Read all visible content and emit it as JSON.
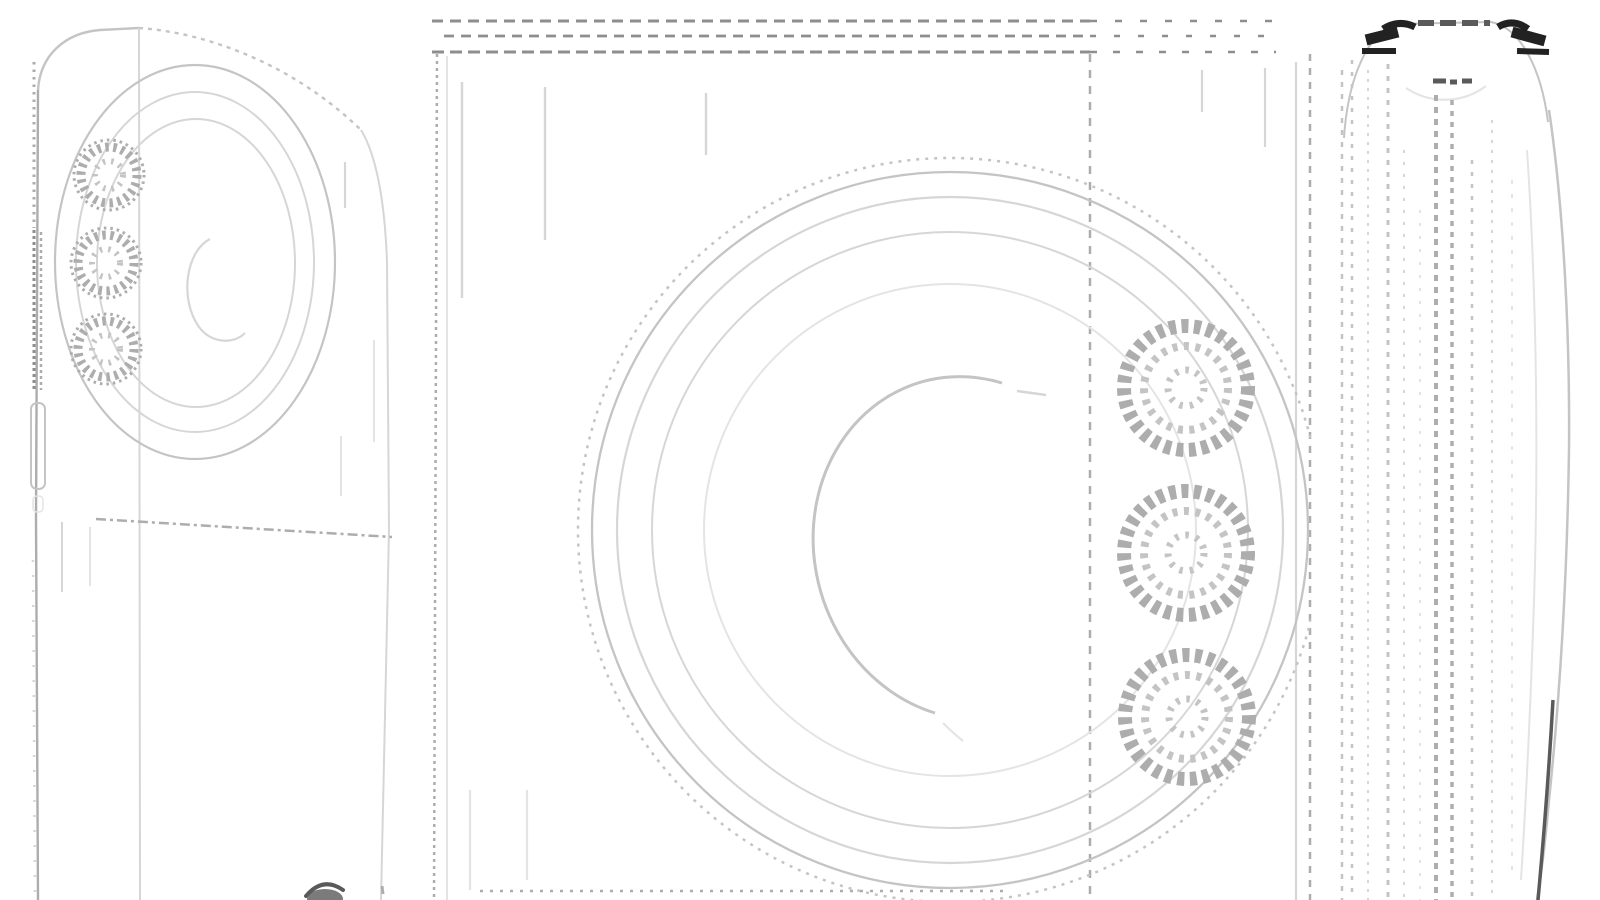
{
  "canvas": {
    "width": 1600,
    "height": 900,
    "background": "#ffffff"
  },
  "colors": {
    "bg": "#ffffff",
    "faint": "#e4e4e4",
    "light": "#d6d6d6",
    "mid": "#c4c4c4",
    "med": "#adadad",
    "strong": "#8e8e8e",
    "dim": "#5a5a5a",
    "dark": "#222222"
  },
  "drawing": {
    "style": "patent-line-drawing",
    "views_count": 3,
    "views": [
      {
        "id": "perspective-view",
        "position": "left",
        "camera_lenses": 3,
        "concentric_rings": 3,
        "side_button": 1
      },
      {
        "id": "back-view",
        "position": "center",
        "concentric_rings": 5,
        "knurled_dials": 3,
        "dashed_top_lines": 3
      },
      {
        "id": "side-view",
        "position": "right",
        "texture_lines": 10,
        "dark_top_marks": 6
      }
    ]
  }
}
